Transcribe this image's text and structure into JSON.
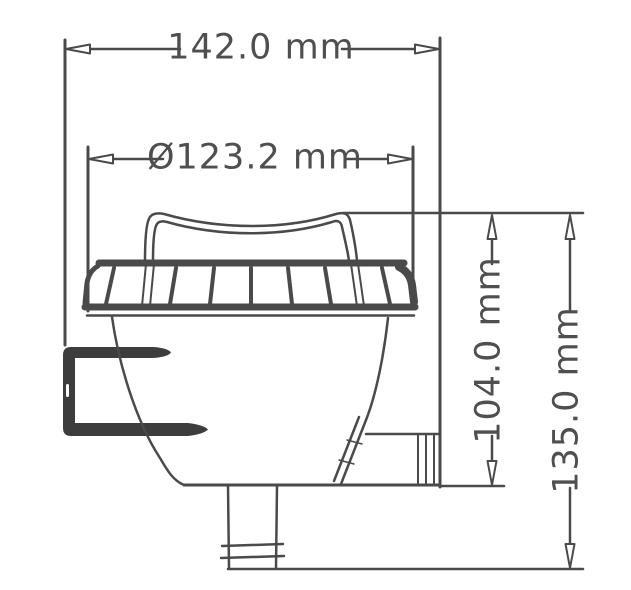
{
  "drawing": {
    "kind": "technical-dimension-drawing",
    "part": "strainer-housing-side-view"
  },
  "dimensions": {
    "overall_width": {
      "label": "142.0 mm",
      "value": 142.0,
      "unit": "mm",
      "orientation": "horizontal"
    },
    "lid_diameter": {
      "label": "Ø123.2 mm",
      "value": 123.2,
      "unit": "mm",
      "orientation": "horizontal",
      "is_diameter": true
    },
    "body_height": {
      "label": "104.0 mm",
      "value": 104.0,
      "unit": "mm",
      "orientation": "vertical"
    },
    "overall_height": {
      "label": "135.0 mm",
      "value": 135.0,
      "unit": "mm",
      "orientation": "vertical"
    }
  },
  "colors": {
    "line": "#4a4a4a",
    "bracket_fill": "#3d3d3d",
    "arrow_fill": "#ffffff",
    "text": "#4f4f4f",
    "background": "#ffffff"
  }
}
